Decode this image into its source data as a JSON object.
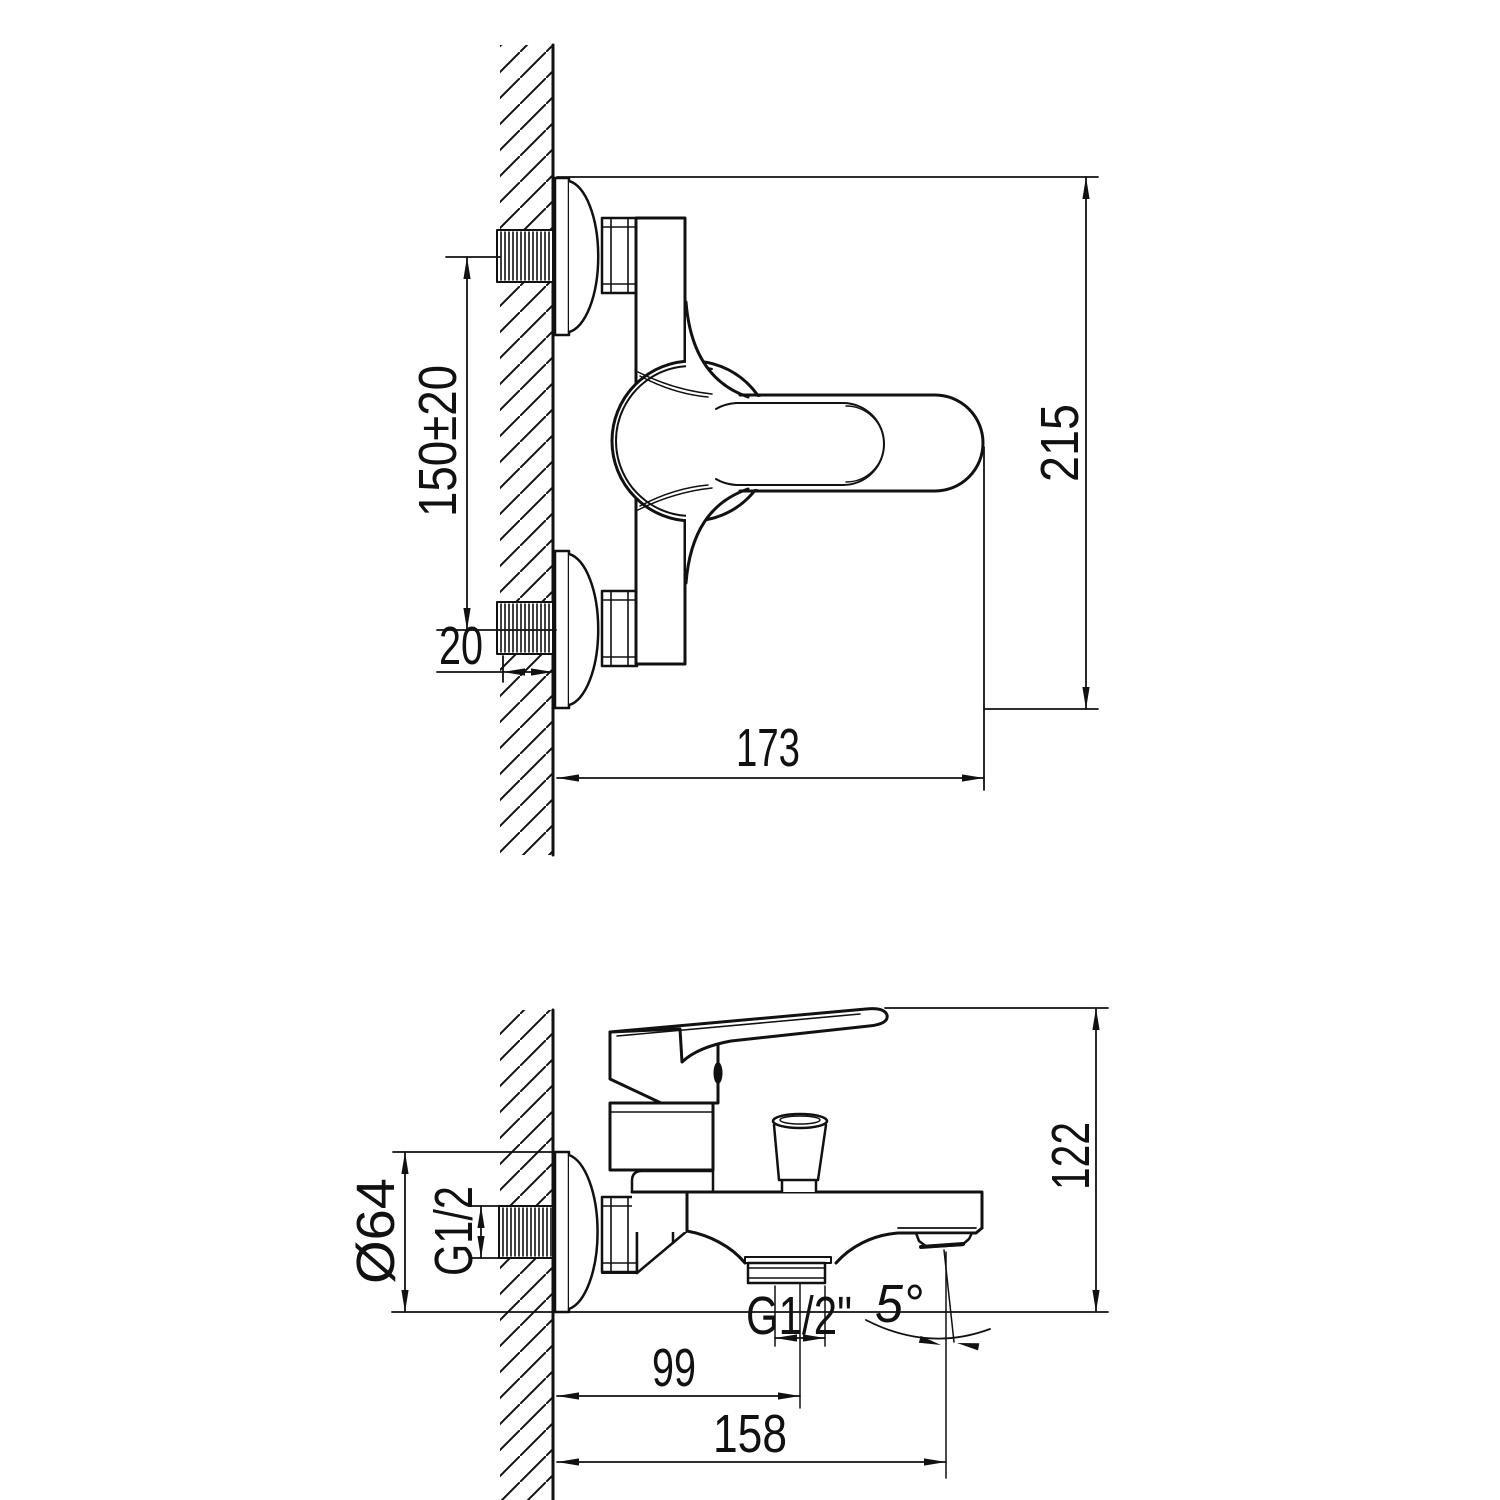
{
  "drawing": {
    "front_view": {
      "dim_mounting_centers": "150±20",
      "dim_wall_depth": "20",
      "dim_width": "173",
      "dim_height": "215"
    },
    "side_view": {
      "dim_escutcheon_diameter": "Ø64",
      "dim_inlet_thread": "G1/2",
      "dim_height": "122",
      "dim_diverter_offset": "99",
      "dim_spout_reach": "158",
      "dim_outlet_thread": "G1/2\"",
      "dim_spout_angle": "5°"
    }
  }
}
